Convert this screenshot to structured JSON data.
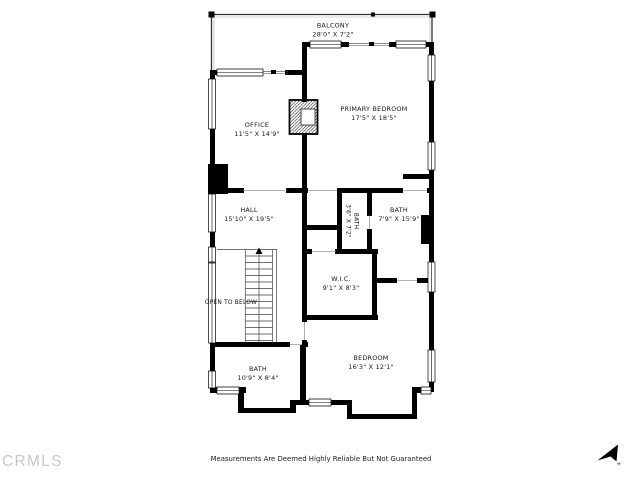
{
  "floorplan": {
    "rooms": {
      "balcony": {
        "label": "BALCONY",
        "dims": "28'0\" X 7'2\""
      },
      "office": {
        "label": "OFFICE",
        "dims": "11'5\" X 14'9\""
      },
      "primary_bedroom": {
        "label": "PRIMARY BEDROOM",
        "dims": "17'5\" X 18'5\""
      },
      "hall": {
        "label": "HALL",
        "dims": "15'10\" X 19'5\""
      },
      "bath_small": {
        "label": "BATH",
        "dims": "3'6\" X 7'2\""
      },
      "bath_primary": {
        "label": "BATH",
        "dims": "7'9\" X 15'9\""
      },
      "wic": {
        "label": "W.I.C.",
        "dims": "9'1\" X 8'3\""
      },
      "open_to_below": {
        "label": "OPEN TO BELOW"
      },
      "bath_lower": {
        "label": "BATH",
        "dims": "10'9\" X 8'4\""
      },
      "bedroom": {
        "label": "BEDROOM",
        "dims": "16'3\" X 12'1\""
      }
    },
    "colors": {
      "wall": "#000000",
      "label": "#161616",
      "watermark": "#c8c8c8",
      "background": "#ffffff"
    }
  },
  "footer": {
    "disclaimer": "Measurements Are Deemed Highly Reliable But Not Guaranteed"
  },
  "watermark": {
    "text": "CRMLS"
  },
  "compass": {
    "label": "N"
  }
}
